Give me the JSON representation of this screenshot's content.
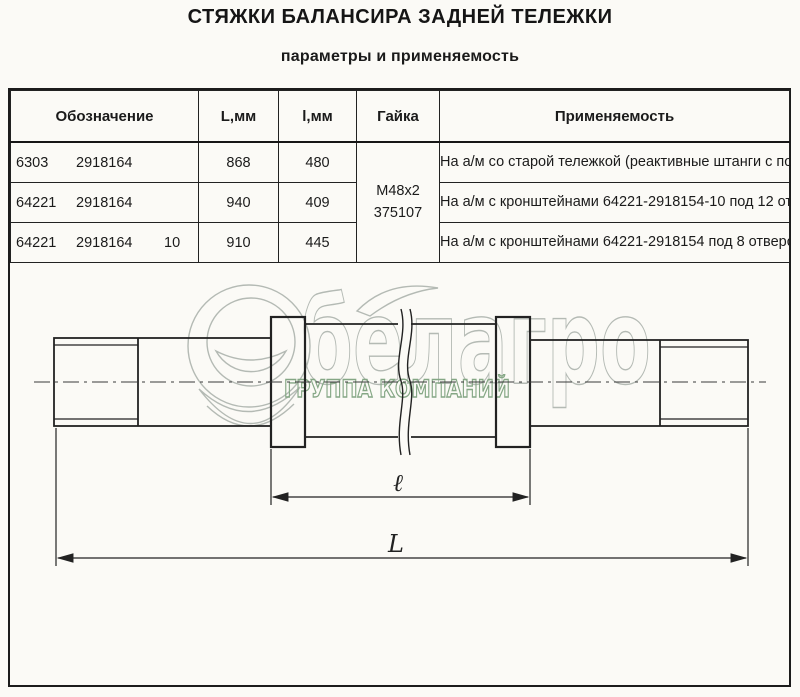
{
  "page": {
    "title": "СТЯЖКИ БАЛАНСИРА ЗАДНЕЙ ТЕЛЕЖКИ",
    "subtitle": "параметры и применяемость"
  },
  "table": {
    "headers": {
      "designation": "Обозначение",
      "length_L": "L,мм",
      "length_l": "l,мм",
      "nut": "Гайка",
      "application": "Применяемость"
    },
    "nut_value": {
      "line1": "M48x2",
      "line2": "375107"
    },
    "rows": [
      {
        "designation": {
          "prefix": "6303",
          "number": "2918164",
          "suffix": ""
        },
        "L": "868",
        "l": "480",
        "application": "На а/м со старой тележкой (реактивные штанги с подшипниками ШС-50 )"
      },
      {
        "designation": {
          "prefix": "64221",
          "number": "2918164",
          "suffix": ""
        },
        "L": "940",
        "l": "409",
        "application": "На а/м с кронштейнами 64221-2918154-10 под 12 отверстий каждый Ф19 мм."
      },
      {
        "designation": {
          "prefix": "64221",
          "number": "2918164",
          "suffix": "10"
        },
        "L": "910",
        "l": "445",
        "application": "На а/м с кронштейнами 64221-2918154 под 8 отверстий каждый Ф25 мм."
      }
    ]
  },
  "drawing": {
    "dim_inner_label": "ℓ",
    "dim_overall_label": "L",
    "line_color": "#222222"
  },
  "watermark": {
    "brand": "белагро",
    "tagline": "ГРУППА КОМПАНИЙ",
    "brand_color": "#b4bab4",
    "tagline_color": "#85a785"
  }
}
